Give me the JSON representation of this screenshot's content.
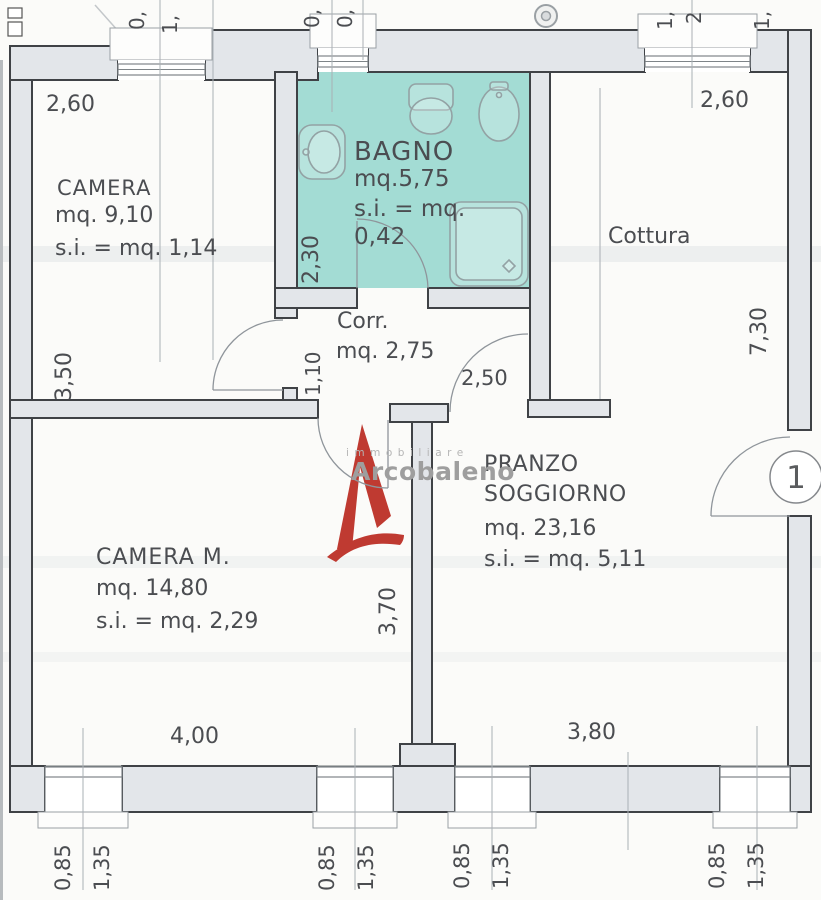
{
  "colors": {
    "bagno_fill": "#a3dcd4",
    "wall_fill": "#e3e6ea",
    "wall_stroke": "#3f4246",
    "accent_red": "#bf3a31",
    "text": "#4b4d51"
  },
  "watermark": {
    "sub": "immobiliare",
    "word": "Arcobaleno"
  },
  "entry": {
    "badge": "1"
  },
  "rooms": {
    "camera": {
      "name": "CAMERA",
      "area": "mq. 9,10",
      "si": "s.i. = mq. 1,14"
    },
    "bagno": {
      "name": "BAGNO",
      "area": "mq.5,75",
      "si1": "s.i. = mq.",
      "si2": "0,42"
    },
    "cottura": {
      "name": "Cottura"
    },
    "corr": {
      "name": "Corr.",
      "area": "mq. 2,75"
    },
    "camera_m": {
      "name": "CAMERA M.",
      "area": "mq. 14,80",
      "si": "s.i. = mq. 2,29"
    },
    "pranzo": {
      "name1": "PRANZO",
      "name2": "SOGGIORNO",
      "area": "mq. 23,16",
      "si": "s.i. = mq. 5,11"
    }
  },
  "dims": {
    "camera_width": "2,60",
    "camera_height": "3,50",
    "bagno_height": "2,30",
    "cottura_width": "2,60",
    "right_height": "7,30",
    "door_corr": "1,10",
    "door_pranzo": "2,50",
    "pranzo_height": "3,70",
    "camera_m_width": "4,00",
    "pranzo_width": "3,80",
    "window_a": "0,85",
    "window_b": "1,35",
    "top_cut": [
      "0,",
      "1,",
      "0,",
      "0,",
      "1,",
      "2",
      "1,"
    ]
  }
}
